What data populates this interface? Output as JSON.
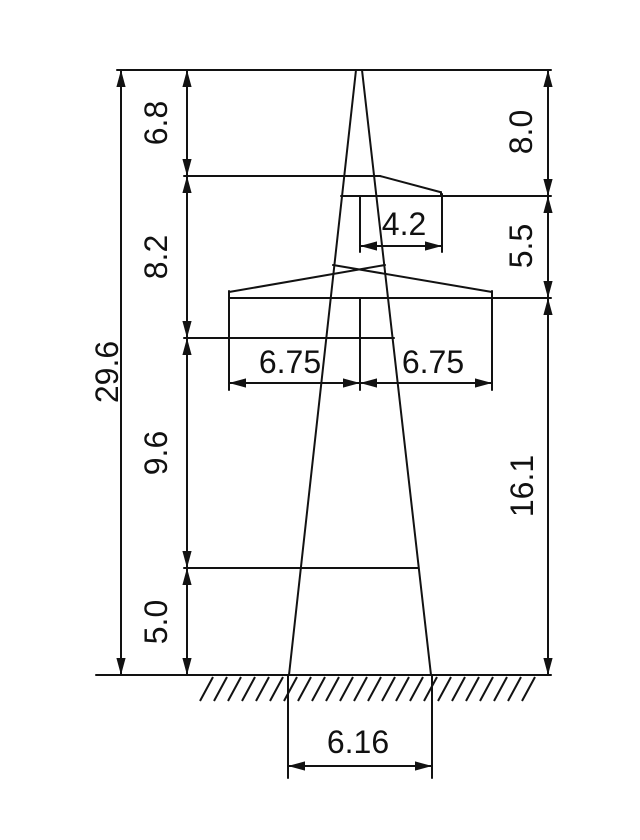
{
  "drawing": {
    "type": "technical_dimension_drawing",
    "subject": "transmission-tower-elevation",
    "canvas": {
      "width": 640,
      "height": 840,
      "background": "#ffffff",
      "line_color": "#121212",
      "line_width": 2,
      "font_size": 32
    },
    "dimension_values": {
      "total_height": "29.6",
      "left_height_segments": [
        "6.8",
        "8.2",
        "9.6",
        "5.0"
      ],
      "right_height_segments": [
        "8.0",
        "5.5",
        "16.1"
      ],
      "upper_crossarm_reach": "4.2",
      "lower_crossarm_left_reach": "6.75",
      "lower_crossarm_right_reach": "6.75",
      "base_width": "6.16"
    },
    "labels": [
      {
        "text": "29.6",
        "x": 107,
        "y": 372,
        "rotated": true,
        "name": "dim-label-total-height"
      },
      {
        "text": "6.8",
        "x": 156,
        "y": 123,
        "rotated": true,
        "name": "dim-label-seg-6-8"
      },
      {
        "text": "8.2",
        "x": 156,
        "y": 257,
        "rotated": true,
        "name": "dim-label-seg-8-2"
      },
      {
        "text": "9.6",
        "x": 156,
        "y": 453,
        "rotated": true,
        "name": "dim-label-seg-9-6"
      },
      {
        "text": "5.0",
        "x": 156,
        "y": 622,
        "rotated": true,
        "name": "dim-label-seg-5-0"
      },
      {
        "text": "8.0",
        "x": 521,
        "y": 132,
        "rotated": true,
        "name": "dim-label-seg-8-0"
      },
      {
        "text": "5.5",
        "x": 521,
        "y": 246,
        "rotated": true,
        "name": "dim-label-seg-5-5"
      },
      {
        "text": "16.1",
        "x": 522,
        "y": 486,
        "rotated": true,
        "name": "dim-label-seg-16-1"
      },
      {
        "text": "4.2",
        "x": 404,
        "y": 224,
        "rotated": false,
        "name": "dim-label-upper-arm"
      },
      {
        "text": "6.75",
        "x": 290,
        "y": 362,
        "rotated": false,
        "name": "dim-label-lower-arm-left"
      },
      {
        "text": "6.75",
        "x": 433,
        "y": 362,
        "rotated": false,
        "name": "dim-label-lower-arm-right"
      },
      {
        "text": "6.16",
        "x": 358,
        "y": 742,
        "rotated": false,
        "name": "dim-label-base-width"
      }
    ],
    "lines": [
      {
        "x1": 117,
        "y1": 70,
        "x2": 551,
        "y2": 70,
        "name": "top-extension-line"
      },
      {
        "x1": 121,
        "y1": 70,
        "x2": 121,
        "y2": 675,
        "name": "dim-line-total-height"
      },
      {
        "x1": 187,
        "y1": 70,
        "x2": 187,
        "y2": 675,
        "name": "dim-line-left-segments"
      },
      {
        "x1": 548,
        "y1": 70,
        "x2": 548,
        "y2": 675,
        "name": "dim-line-right-segments"
      },
      {
        "x1": 96,
        "y1": 675,
        "x2": 551,
        "y2": 675,
        "name": "ground-line"
      },
      {
        "x1": 356,
        "y1": 70,
        "x2": 289,
        "y2": 675,
        "name": "tower-leg-left"
      },
      {
        "x1": 362,
        "y1": 70,
        "x2": 431,
        "y2": 675,
        "name": "tower-leg-right"
      },
      {
        "x1": 288,
        "y1": 675,
        "x2": 288,
        "y2": 778,
        "name": "base-extension-left"
      },
      {
        "x1": 432,
        "y1": 675,
        "x2": 432,
        "y2": 778,
        "name": "base-extension-right"
      },
      {
        "x1": 288,
        "y1": 766,
        "x2": 432,
        "y2": 766,
        "name": "dim-line-base-width"
      },
      {
        "x1": 184,
        "y1": 176,
        "x2": 380,
        "y2": 176,
        "name": "upper-arm-top"
      },
      {
        "x1": 380,
        "y1": 176,
        "x2": 440,
        "y2": 192,
        "name": "upper-arm-slope"
      },
      {
        "x1": 441,
        "y1": 192,
        "x2": 441,
        "y2": 196,
        "name": "upper-arm-tip-face"
      },
      {
        "x1": 341,
        "y1": 196,
        "x2": 551,
        "y2": 196,
        "name": "upper-arm-bottom"
      },
      {
        "x1": 442,
        "y1": 194,
        "x2": 442,
        "y2": 252,
        "name": "ext-upper-arm-tip"
      },
      {
        "x1": 360,
        "y1": 196,
        "x2": 360,
        "y2": 252,
        "name": "ext-upper-center"
      },
      {
        "x1": 360,
        "y1": 246,
        "x2": 442,
        "y2": 246,
        "name": "dim-line-upper-arm"
      },
      {
        "x1": 229,
        "y1": 292,
        "x2": 385,
        "y2": 265,
        "name": "lower-arm-roof-left"
      },
      {
        "x1": 492,
        "y1": 292,
        "x2": 333,
        "y2": 265,
        "name": "lower-arm-roof-right"
      },
      {
        "x1": 229,
        "y1": 291,
        "x2": 229,
        "y2": 298,
        "name": "lower-arm-tip-left"
      },
      {
        "x1": 492,
        "y1": 291,
        "x2": 492,
        "y2": 298,
        "name": "lower-arm-tip-right"
      },
      {
        "x1": 229,
        "y1": 298,
        "x2": 551,
        "y2": 298,
        "name": "lower-arm-bottom"
      },
      {
        "x1": 184,
        "y1": 338,
        "x2": 394,
        "y2": 338,
        "name": "brace-extension-mid"
      },
      {
        "x1": 184,
        "y1": 568,
        "x2": 418,
        "y2": 568,
        "name": "brace-extension-low"
      },
      {
        "x1": 229,
        "y1": 298,
        "x2": 229,
        "y2": 390,
        "name": "ext-lower-tip-left"
      },
      {
        "x1": 360,
        "y1": 298,
        "x2": 360,
        "y2": 390,
        "name": "ext-lower-center"
      },
      {
        "x1": 492,
        "y1": 298,
        "x2": 492,
        "y2": 390,
        "name": "ext-lower-tip-right"
      },
      {
        "x1": 229,
        "y1": 383,
        "x2": 360,
        "y2": 383,
        "name": "dim-line-lower-arm-left"
      },
      {
        "x1": 360,
        "y1": 383,
        "x2": 492,
        "y2": 383,
        "name": "dim-line-lower-arm-right"
      }
    ],
    "arrows": [
      {
        "x": 121,
        "y": 70,
        "dir": "up"
      },
      {
        "x": 121,
        "y": 675,
        "dir": "down"
      },
      {
        "x": 187,
        "y": 70,
        "dir": "up"
      },
      {
        "x": 187,
        "y": 176,
        "dir": "down"
      },
      {
        "x": 187,
        "y": 176,
        "dir": "up"
      },
      {
        "x": 187,
        "y": 338,
        "dir": "down"
      },
      {
        "x": 187,
        "y": 338,
        "dir": "up"
      },
      {
        "x": 187,
        "y": 568,
        "dir": "down"
      },
      {
        "x": 187,
        "y": 568,
        "dir": "up"
      },
      {
        "x": 187,
        "y": 675,
        "dir": "down"
      },
      {
        "x": 548,
        "y": 70,
        "dir": "up"
      },
      {
        "x": 548,
        "y": 196,
        "dir": "down"
      },
      {
        "x": 548,
        "y": 196,
        "dir": "up"
      },
      {
        "x": 548,
        "y": 298,
        "dir": "down"
      },
      {
        "x": 548,
        "y": 298,
        "dir": "up"
      },
      {
        "x": 548,
        "y": 675,
        "dir": "down"
      },
      {
        "x": 360,
        "y": 246,
        "dir": "left"
      },
      {
        "x": 442,
        "y": 246,
        "dir": "right"
      },
      {
        "x": 229,
        "y": 383,
        "dir": "left"
      },
      {
        "x": 360,
        "y": 383,
        "dir": "right"
      },
      {
        "x": 360,
        "y": 383,
        "dir": "left"
      },
      {
        "x": 492,
        "y": 383,
        "dir": "right"
      },
      {
        "x": 288,
        "y": 766,
        "dir": "left"
      },
      {
        "x": 432,
        "y": 766,
        "dir": "right"
      }
    ],
    "hatch": {
      "x_start": 200,
      "x_end": 526,
      "y_top": 677,
      "y_bottom": 701,
      "step": 14,
      "slant": 13
    }
  }
}
